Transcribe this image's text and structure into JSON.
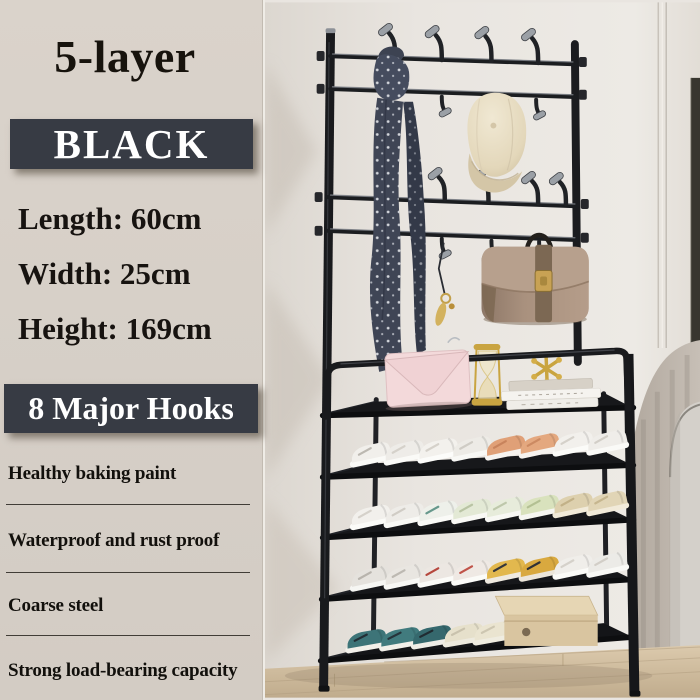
{
  "panel": {
    "title": "5-layer",
    "color_box": "BLACK",
    "specs": [
      "Length: 60cm",
      "Width: 25cm",
      "Height: 169cm"
    ],
    "hooks_box": "8 Major Hooks",
    "features": [
      "Healthy baking paint",
      "Waterproof and rust proof",
      "Coarse steel",
      "Strong load-bearing capacity"
    ]
  },
  "photo": {
    "product": "black 5-layer entryway shoe rack with coat hook frame",
    "visible_items": [
      "polka-dot-scarf",
      "fleece-cap",
      "taupe-handbag",
      "gold-keychain",
      "pink-clutch",
      "gold-hourglass",
      "gold-jack-ornament",
      "books",
      "sneaker-rows",
      "cardboard-shoe-box",
      "ottoman",
      "wood-floor"
    ]
  },
  "colors": {
    "panel_bg": "#d7d0c8",
    "label_box_bg": "#373b44",
    "label_box_text": "#ffffff",
    "panel_text": "#171310",
    "wall": "#e9e5e0",
    "rack_metal": "#1b1c1f",
    "hook_tip": "#9ba0a6",
    "scarf": "#3f4555",
    "cap": "#e6dcc2",
    "handbag": "#a58c79",
    "clutch": "#f3d9da",
    "gold": "#c9a43f",
    "carton_box": "#d9c5a0",
    "floor_wood": "#cfbd9f"
  }
}
